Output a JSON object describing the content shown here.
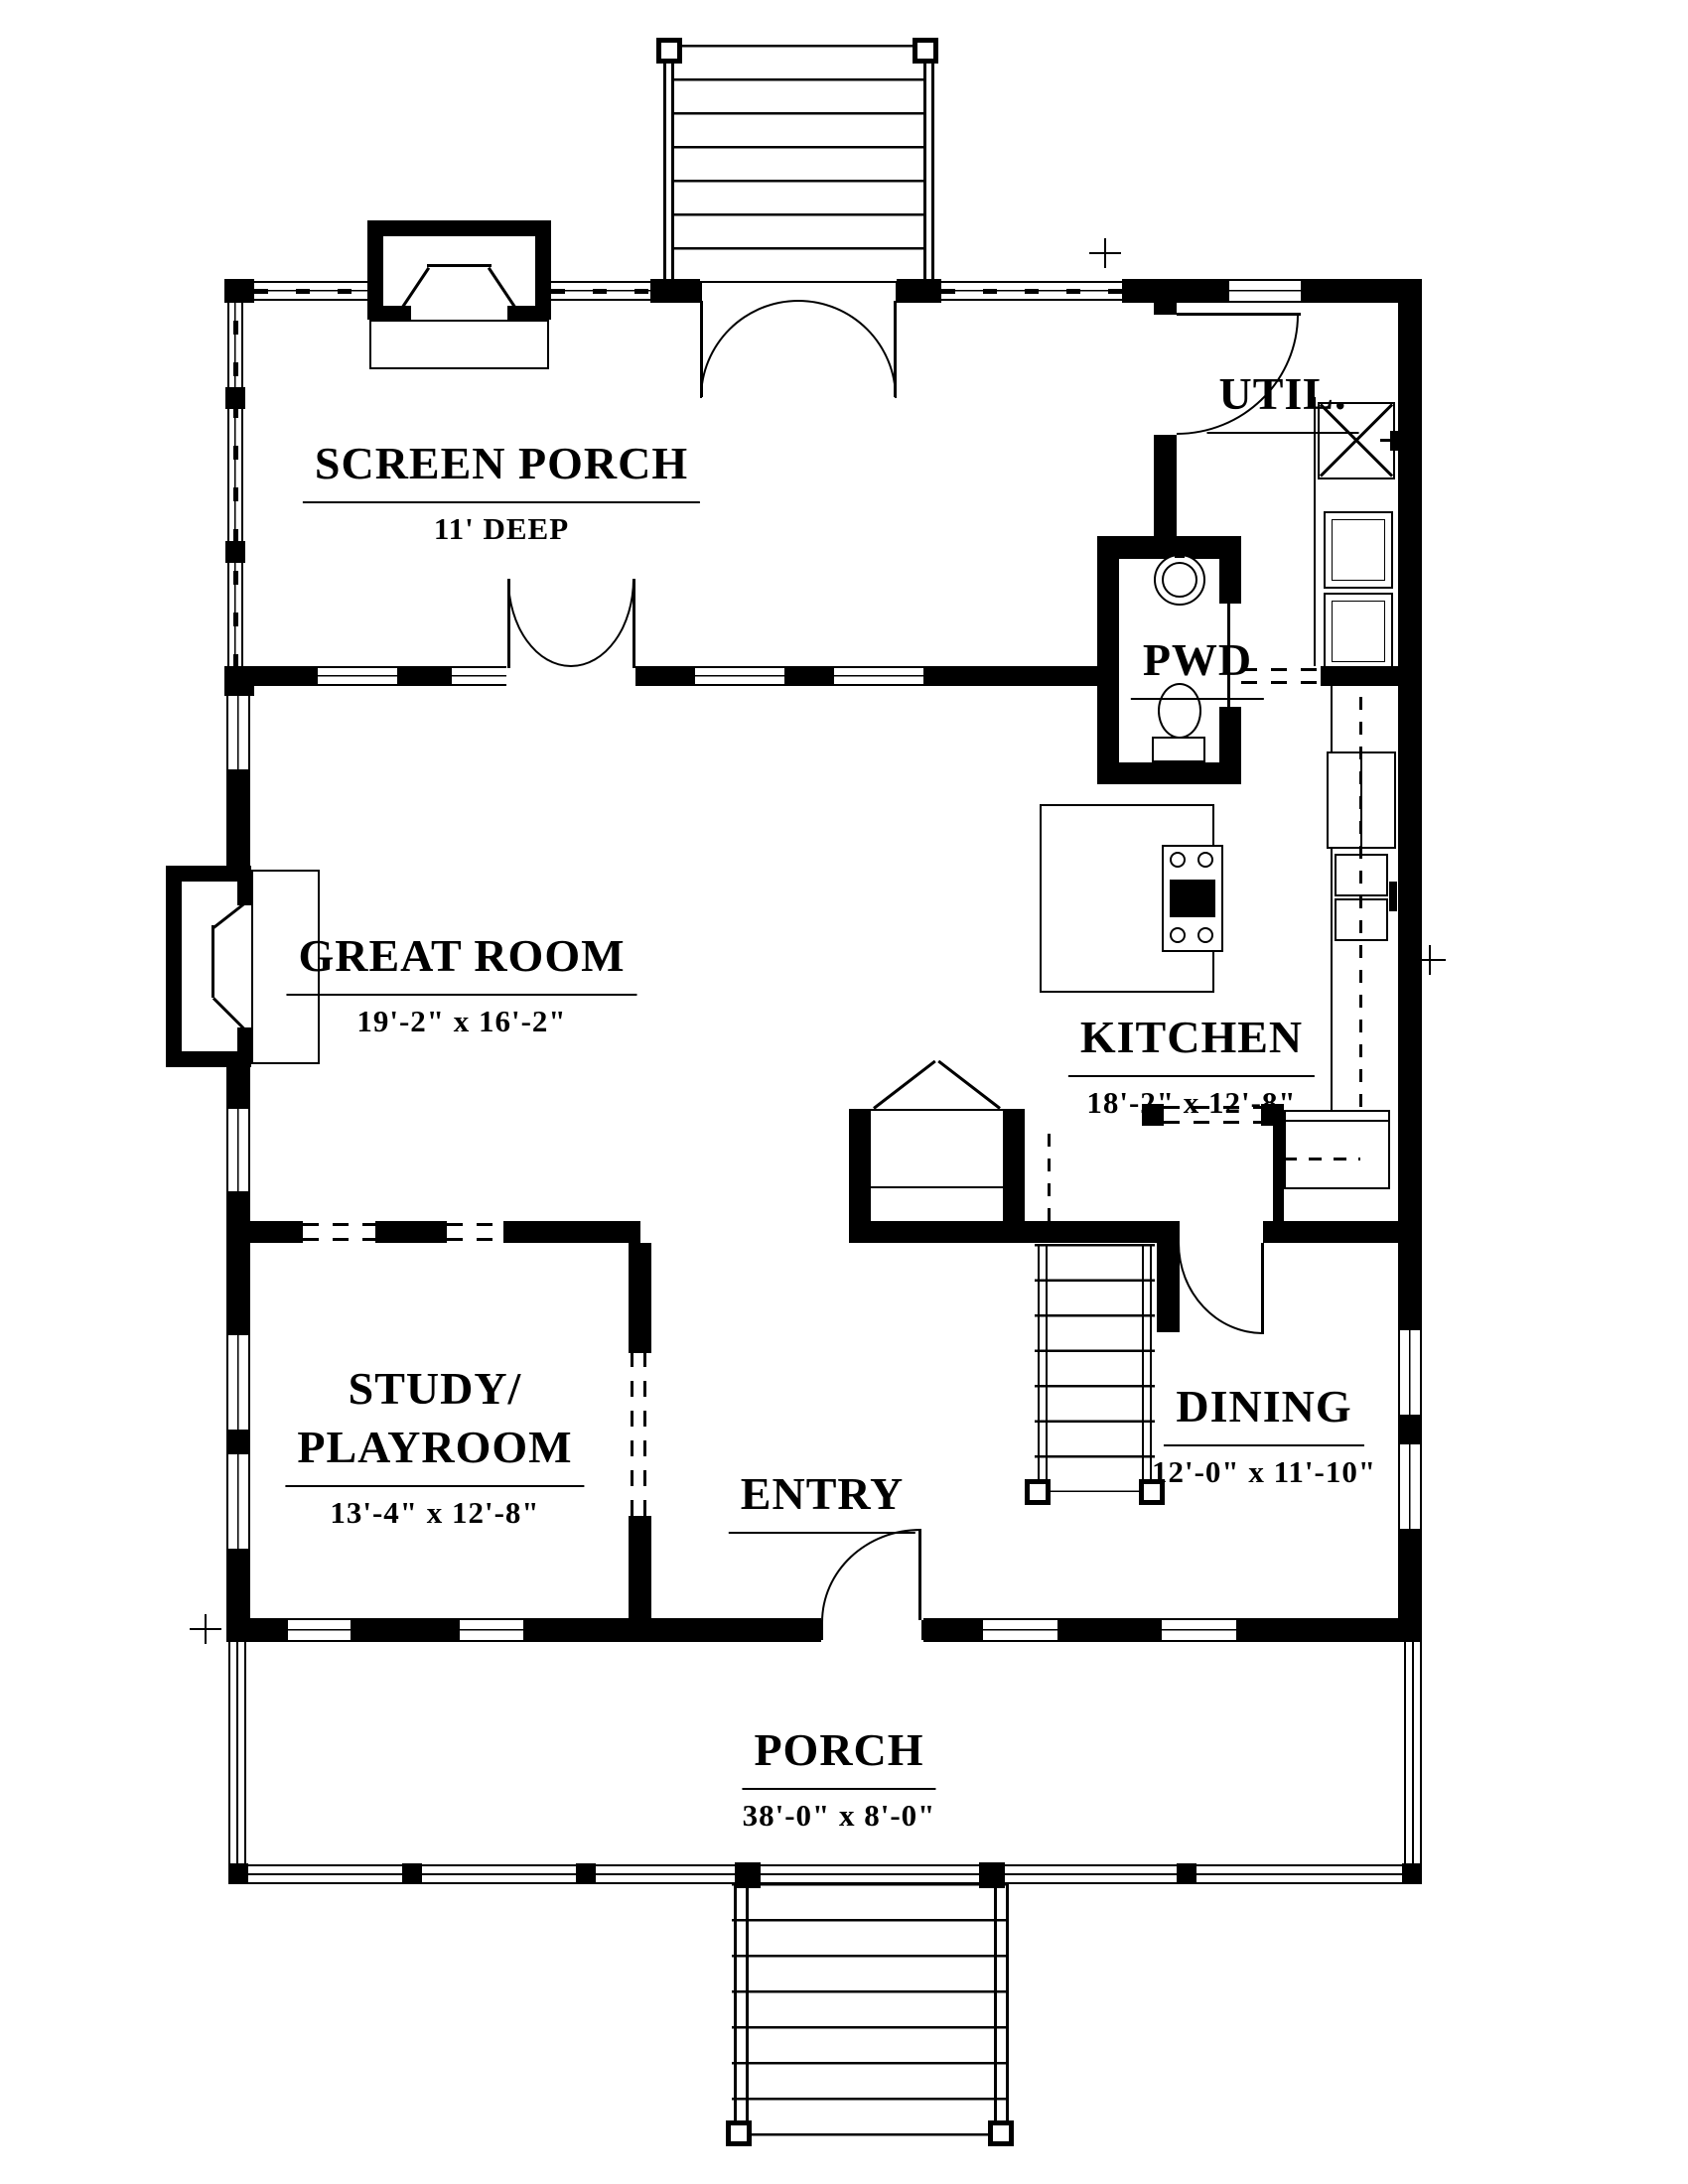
{
  "rooms": {
    "screen_porch": {
      "name": "SCREEN PORCH",
      "dims": "11' DEEP"
    },
    "util": {
      "name": "UTIL."
    },
    "pwd": {
      "name": "PWD"
    },
    "great_room": {
      "name": "GREAT ROOM",
      "dims": "19'-2\" x 16'-2\""
    },
    "kitchen": {
      "name": "KITCHEN",
      "dims": "18'-2\" x 12'-8\""
    },
    "study": {
      "name": "STUDY/\nPLAYROOM",
      "dims": "13'-4\" x 12'-8\""
    },
    "entry": {
      "name": "ENTRY"
    },
    "dining": {
      "name": "DINING",
      "dims": "12'-0\" x 11'-10\""
    },
    "porch": {
      "name": "PORCH",
      "dims": "38'-0\" x 8'-0\""
    }
  },
  "colors": {
    "ink": "#000000",
    "paper": "#ffffff"
  }
}
